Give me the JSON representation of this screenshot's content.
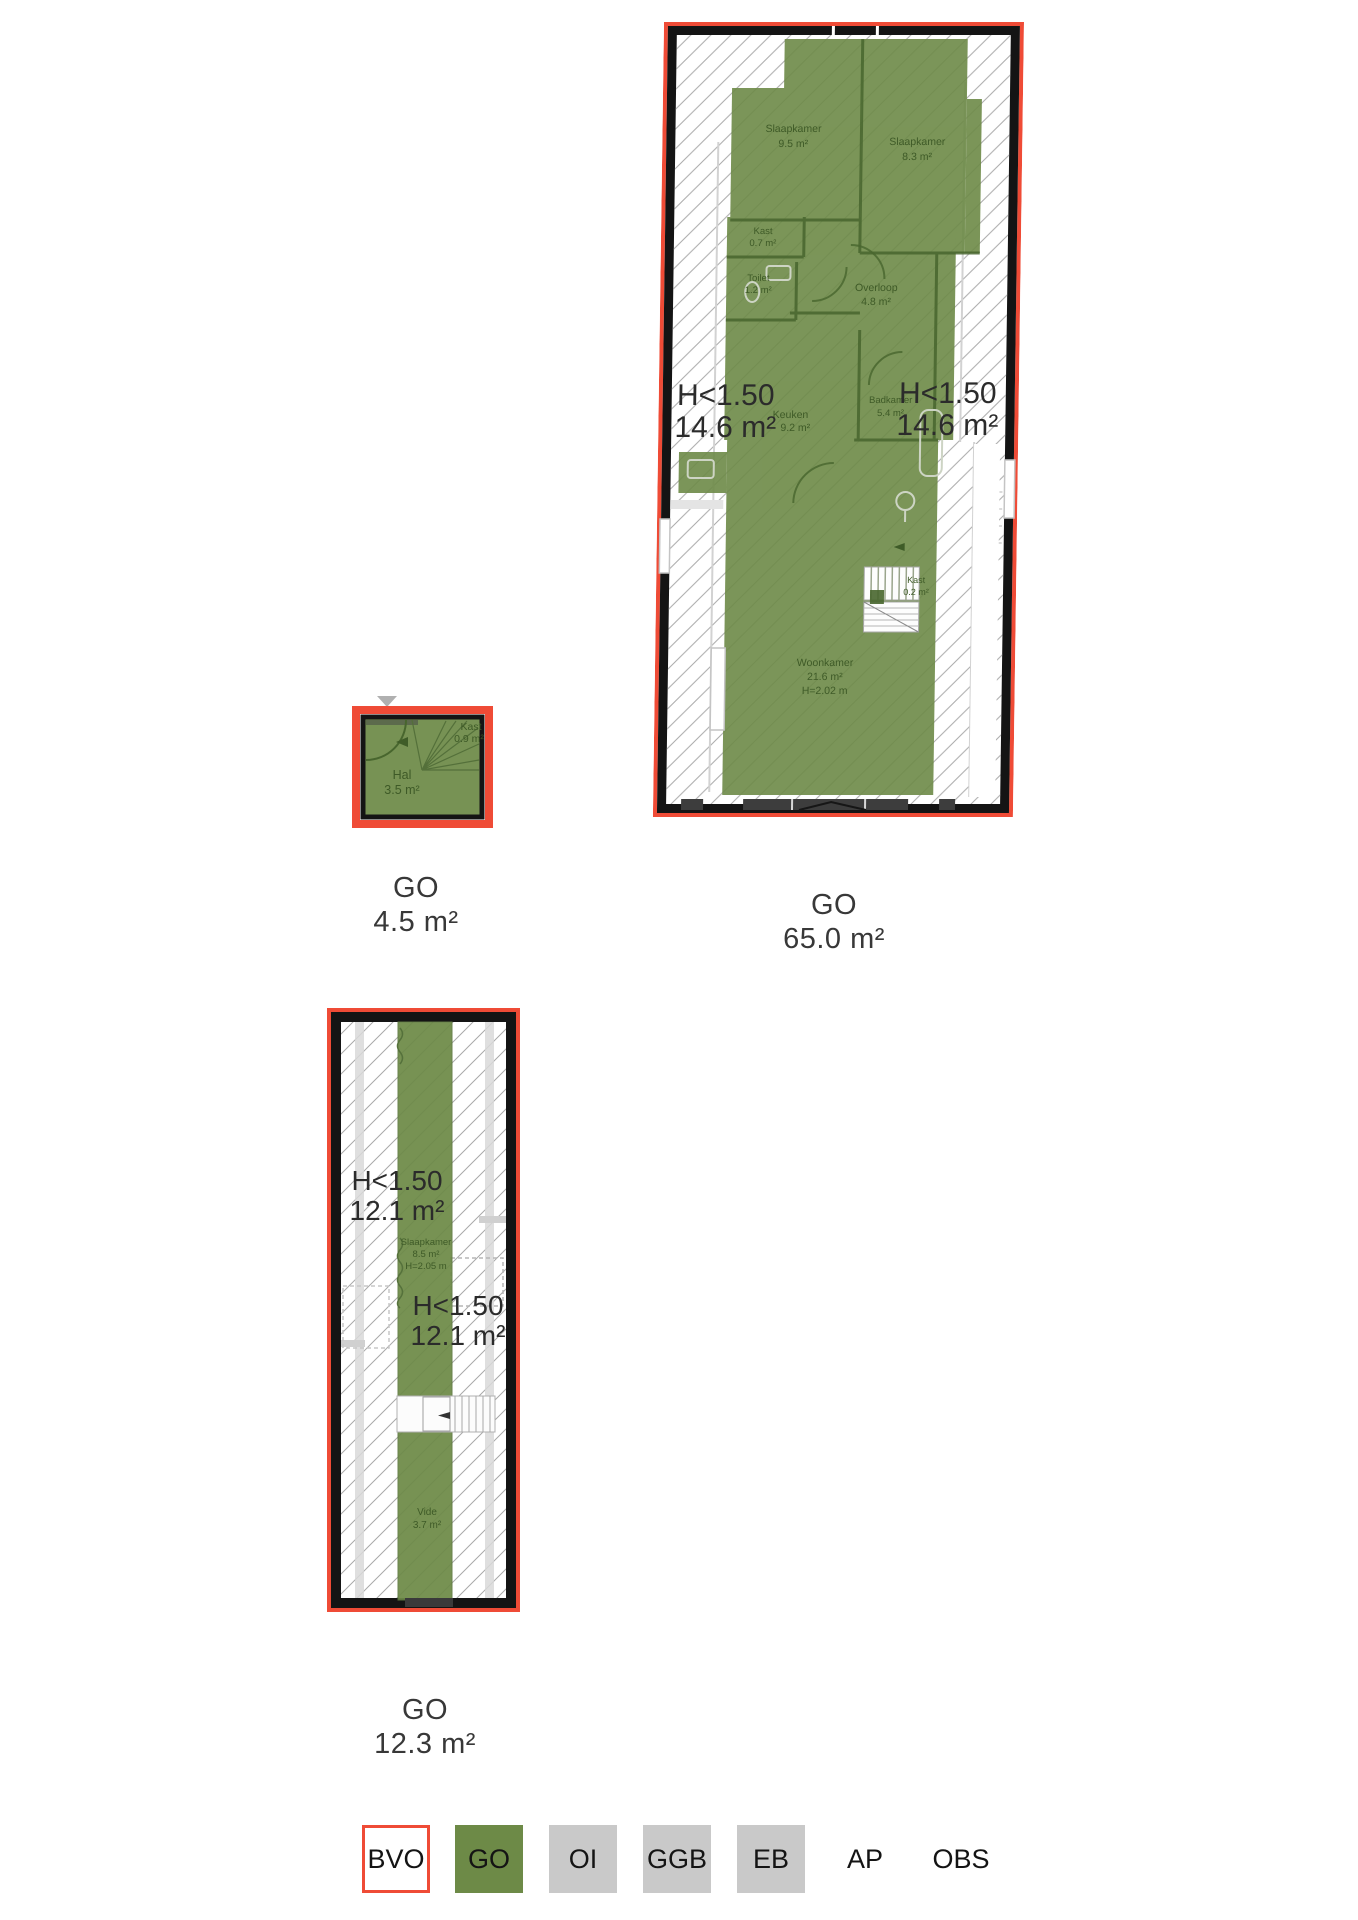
{
  "colors": {
    "go_green": "#6d8a47",
    "bvo_red": "#ef4b36",
    "legend_gray": "#c9c9c9",
    "wall_black": "#141414",
    "room_text_green": "#3e5a27",
    "label_text": "#383838"
  },
  "plans": {
    "upper": {
      "go": {
        "code": "GO",
        "area": "65.0 m²"
      },
      "low1": {
        "label": "H<1.50",
        "area": "14.6 m²"
      },
      "low2": {
        "label": "H<1.50",
        "area": "14.6 m²"
      },
      "rooms": {
        "slaapkamer1": {
          "name": "Slaapkamer",
          "area": "9.5 m²"
        },
        "slaapkamer2": {
          "name": "Slaapkamer",
          "area": "8.3 m²"
        },
        "kast1": {
          "name": "Kast",
          "area": "0.7 m²"
        },
        "toilet": {
          "name": "Toilet",
          "area": "1.2 m²"
        },
        "overloop": {
          "name": "Overloop",
          "area": "4.8 m²"
        },
        "keuken": {
          "name": "Keuken",
          "area": "9.2 m²"
        },
        "badkamer": {
          "name": "Badkamer",
          "area": "5.4 m²"
        },
        "kast2": {
          "name": "Kast",
          "area": "0.2 m²"
        },
        "woonkamer": {
          "name": "Woonkamer",
          "area": "21.6 m²",
          "height": "H=2.02 m"
        }
      }
    },
    "hal": {
      "go": {
        "code": "GO",
        "area": "4.5 m²"
      },
      "rooms": {
        "kast": {
          "name": "Kast",
          "area": "0.9 m²"
        },
        "hal": {
          "name": "Hal",
          "area": "3.5 m²"
        }
      }
    },
    "attic": {
      "go": {
        "code": "GO",
        "area": "12.3 m²"
      },
      "low1": {
        "label": "H<1.50",
        "area": "12.1 m²"
      },
      "low2": {
        "label": "H<1.50",
        "area": "12.1 m²"
      },
      "rooms": {
        "slaapkamer": {
          "name": "Slaapkamer",
          "area": "8.5 m²",
          "height": "H=2.05 m"
        },
        "vide": {
          "name": "Vide",
          "area": "3.7 m²"
        }
      }
    }
  },
  "legend": {
    "bvo": "BVO",
    "go": "GO",
    "oi": "OI",
    "ggb": "GGB",
    "eb": "EB",
    "ap": "AP",
    "obs": "OBS"
  }
}
